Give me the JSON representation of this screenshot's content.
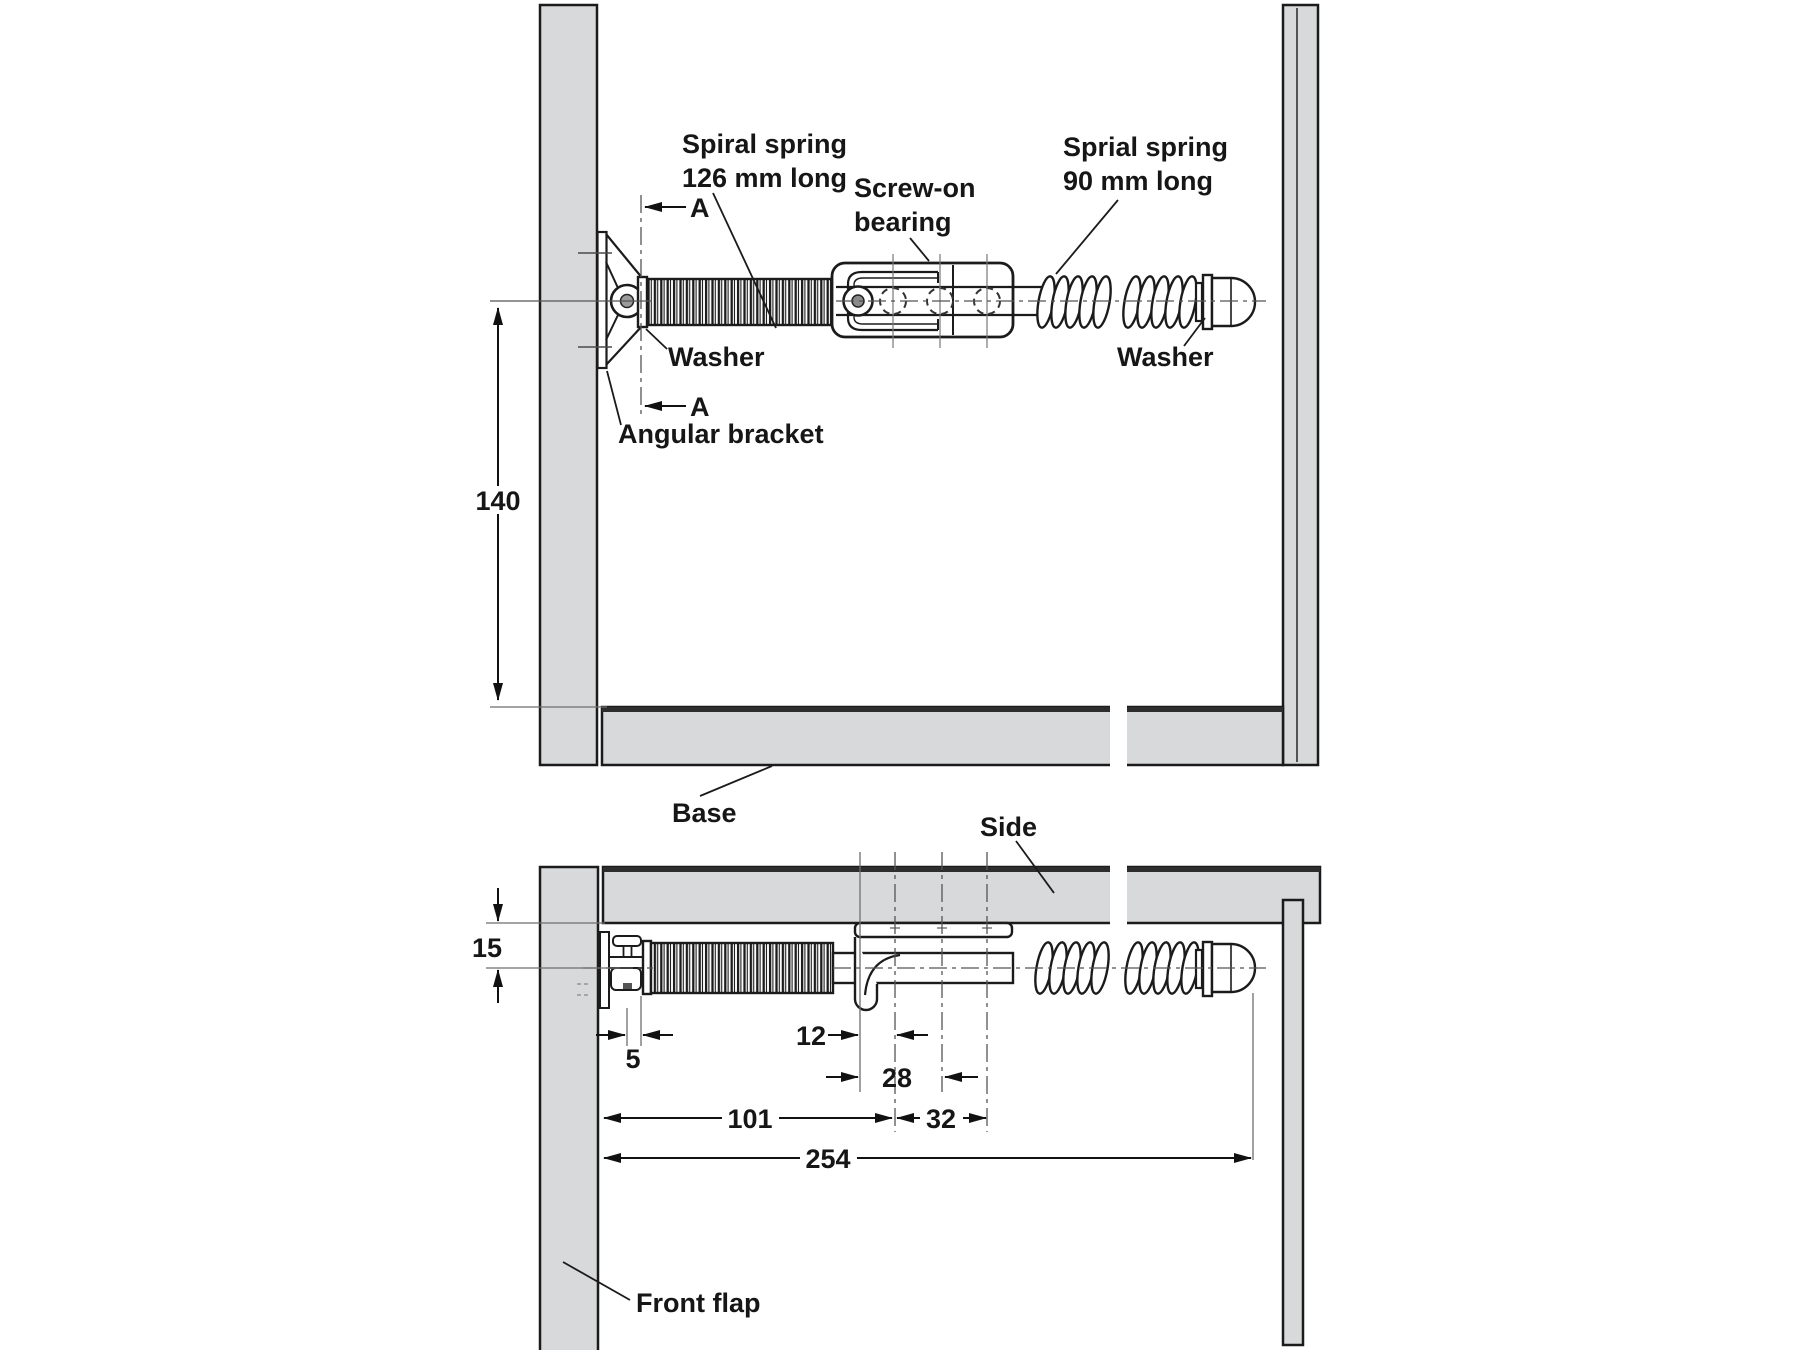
{
  "top_view": {
    "labels": {
      "spiral_spring_l1": "Spiral spring",
      "spiral_spring_l2": "126 mm long",
      "screw_on_l1": "Screw-on",
      "screw_on_l2": "bearing",
      "sprial_spring_l1": "Sprial spring",
      "sprial_spring_l2": "90 mm long",
      "washer_left": "Washer",
      "washer_right": "Washer",
      "angular_bracket": "Angular bracket",
      "base": "Base",
      "section_a_top": "A",
      "section_a_bottom": "A"
    },
    "dimensions": {
      "bracket_height": "140"
    }
  },
  "side_view": {
    "labels": {
      "side": "Side",
      "front_flap": "Front flap"
    },
    "dimensions": {
      "panel_to_axis": "15",
      "washer_offset": "5",
      "hook_to_first_hole": "12",
      "hook_to_second_hole": "28",
      "flap_to_first_hole": "101",
      "first_to_third_hole": "32",
      "overall_length": "254"
    }
  },
  "colors": {
    "panel_fill": "#d8d9da",
    "line": "#1b1b1b",
    "dim_line": "#111111",
    "ext_line": "#6e6e6e"
  }
}
